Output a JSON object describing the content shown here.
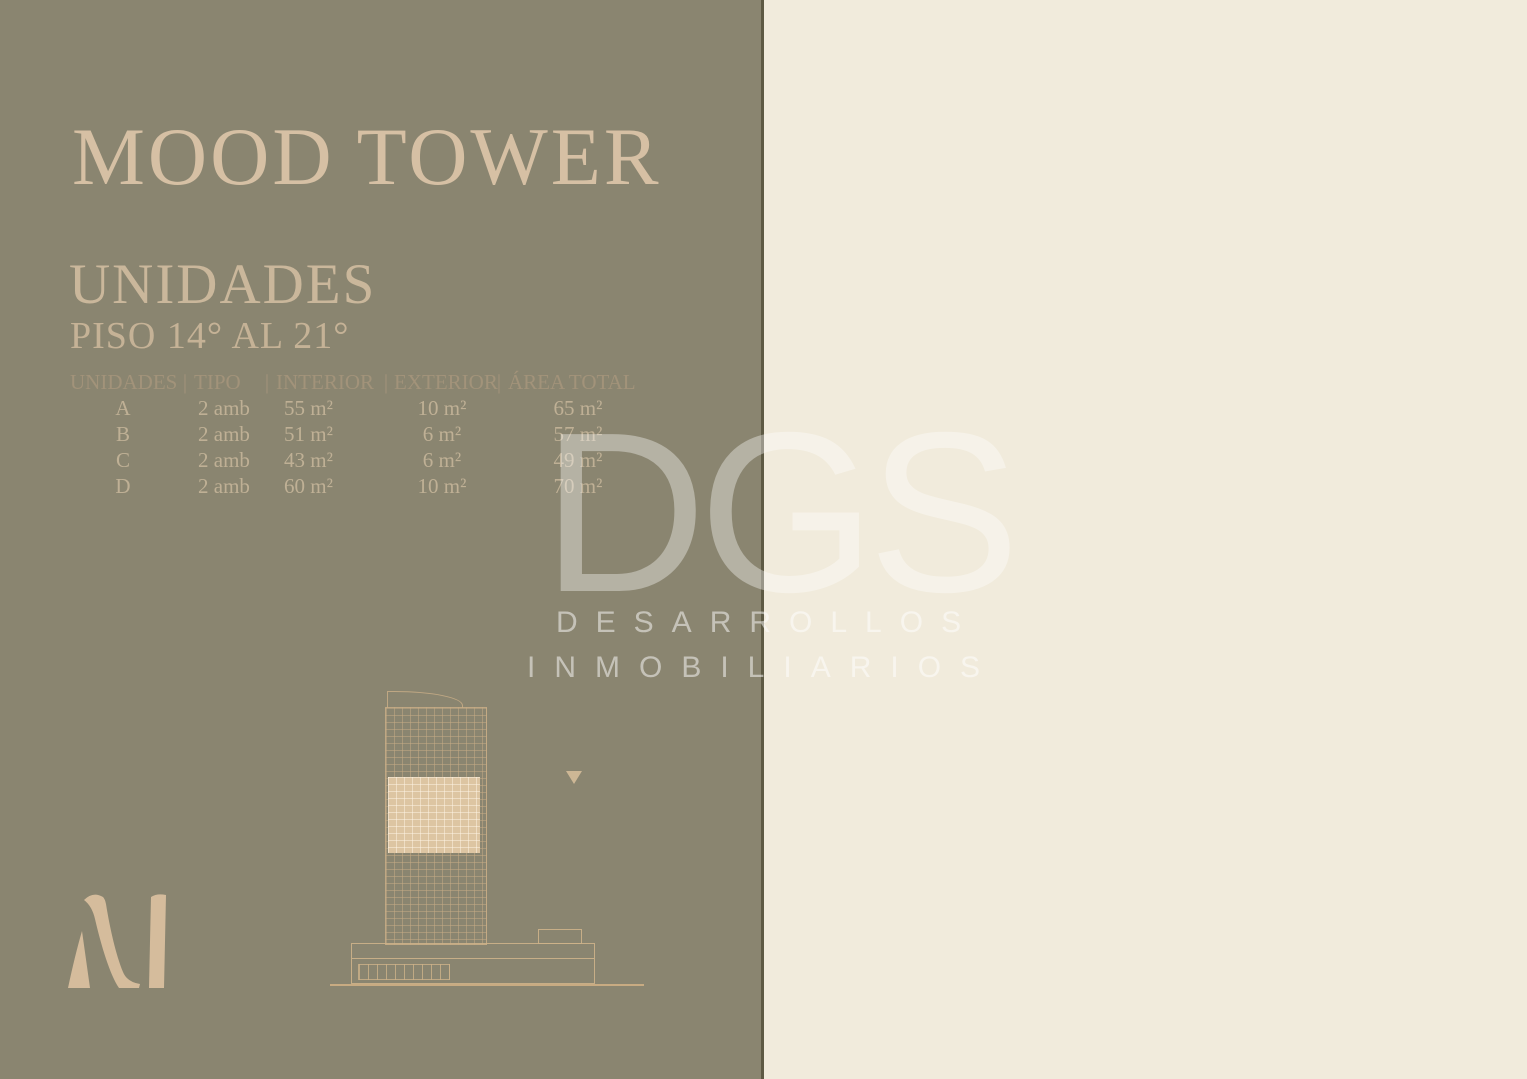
{
  "colors": {
    "panel_left_bg": "#8a8570",
    "panel_right_bg": "#f1ebdc",
    "divider": "#5e5a44",
    "title_text": "#d6c0a4",
    "table_header_text": "#a2937a",
    "table_row_text": "#bfb095",
    "plan_wall": "#272320",
    "plan_room_fill": "#e8dcca",
    "logo_fill": "#d5bc9c"
  },
  "header": {
    "title": "MOOD TOWER",
    "section": "UNIDADES",
    "subtitle": "PISO 14° AL 21°"
  },
  "units_table": {
    "separator": "|",
    "columns": [
      "UNIDADES",
      "TIPO",
      "INTERIOR",
      "EXTERIOR",
      "ÁREA TOTAL"
    ],
    "rows": [
      {
        "unidad": "A",
        "tipo": "2 amb",
        "interior": "55 m²",
        "exterior": "10 m²",
        "area_total": "65 m²"
      },
      {
        "unidad": "B",
        "tipo": "2 amb",
        "interior": "51 m²",
        "exterior": "6 m²",
        "area_total": "57 m²"
      },
      {
        "unidad": "C",
        "tipo": "2 amb",
        "interior": "43 m²",
        "exterior": "6 m²",
        "area_total": "49 m²"
      },
      {
        "unidad": "D",
        "tipo": "2 amb",
        "interior": "60 m²",
        "exterior": "10 m²",
        "area_total": "70 m²"
      }
    ]
  },
  "watermark": {
    "acronym": "DGS",
    "line1": "DESARROLLOS",
    "line2": "INMOBILIARIOS"
  },
  "logo_letter": "M",
  "floor_plan": {
    "labels": {
      "a": "A",
      "b": "B",
      "c": "C",
      "d": "D"
    },
    "street": "AV. HIPÓLITO YRIGOYEN"
  },
  "footer": {
    "disclaimer": "Todas las plantas, renders y descrípciones son preliminares y están sujetas a modificaciones."
  }
}
